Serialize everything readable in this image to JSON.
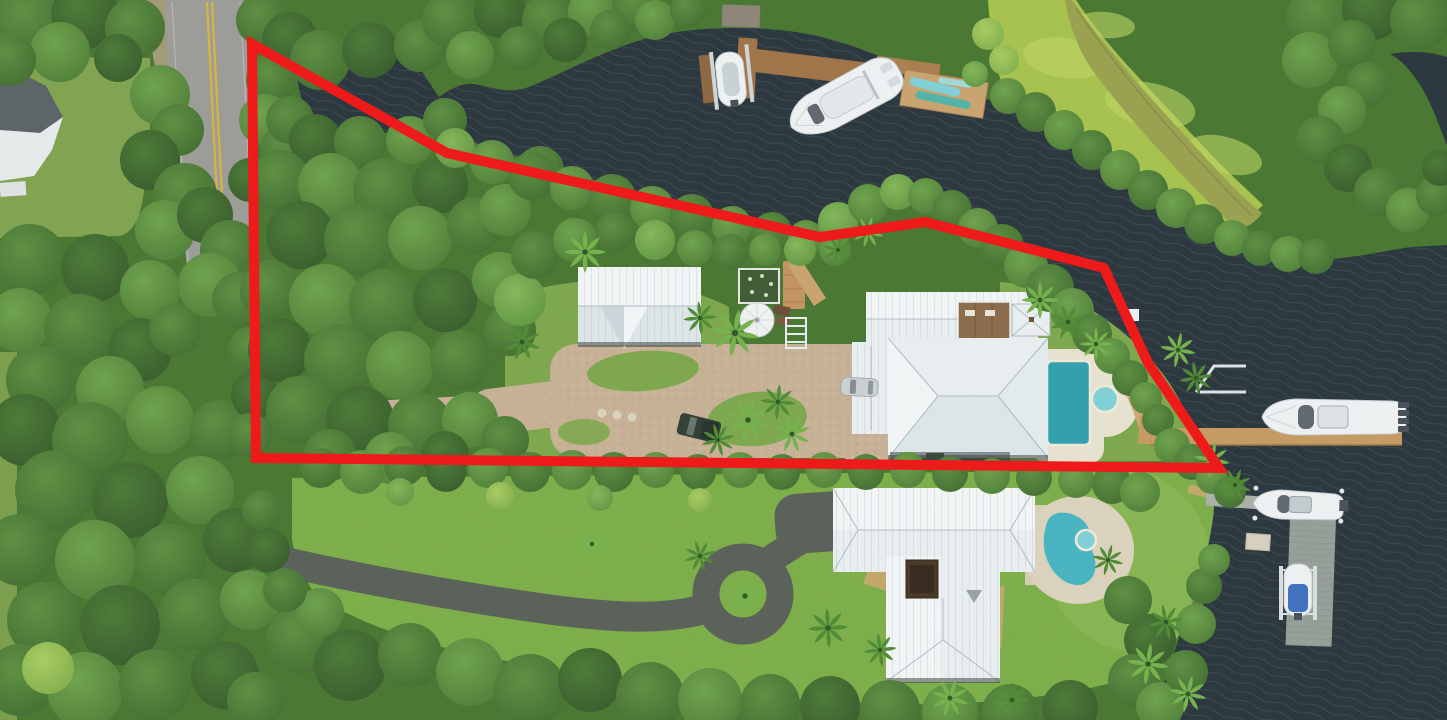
{
  "meta": {
    "type": "aerial-drone-photograph",
    "subject": "Top-down aerial photo of a wooded waterfront estate outlined with a red property boundary, beside a dark tidal canal and river with docks and boats",
    "visible_text": "none"
  },
  "colors": {
    "canopy": "#47762f",
    "treeDark": "#38622a",
    "treeMid": "#4c8034",
    "treeLight": "#5f9740",
    "treeBright": "#79ae4f",
    "treeLime": "#9cc35a",
    "water": "#28343b",
    "waterWave": "#93a7b1",
    "marsh": "#a7c24c",
    "marshLight": "#bdd561",
    "channel": "#99a14e",
    "road": "#9b9b97",
    "roadLine": "#d9b43e",
    "lawn": "#7ca74b",
    "lawnLower": "#7bae47",
    "lawnMuted": "#7fa34f",
    "lawnSlope": "#8fbb57",
    "gravel": "#c7b195",
    "asphalt": "#585f57",
    "sand": "#cfa671",
    "roofBright": "#f3f6f7",
    "roofLight": "#eaeff1",
    "roofMid": "#dde6e9",
    "roofShade": "#ccd7db",
    "roofLine": "#9fb0b6",
    "wood": "#8a6b4a",
    "deckTan": "#c9a36e",
    "patio": "#dcd3bd",
    "patioLight": "#e8e2d0",
    "poolUpper": "#2f9fae",
    "poolLower": "#46b4c1",
    "spa": "#7fd0d8",
    "dockBrown": "#a07246",
    "dockTan": "#c59a60",
    "dockGray": "#a9b0a8",
    "dockGrayDark": "#959e97",
    "boatWhite": "#eff2f3",
    "boatGray": "#c3cdd1",
    "boatDark": "#454f56",
    "coverBlue": "#3f6fbe",
    "kayakBlue": "#7fd0d8",
    "kayakTeal": "#4fb3a6",
    "truck": "#2f3d35",
    "carSilver": "#ccd1d2",
    "boundary": "#f01515",
    "palmDark": "#4e8a33",
    "palmLight": "#74b24a"
  },
  "boundary": {
    "label": "red property boundary outline",
    "points": "252,44 447,153 820,237 925,222 1104,268 1148,363 1219,468 256,458",
    "strokeWidth": 10
  },
  "features": {
    "road": "two-lane road with double yellow centerline under trees, upper left",
    "neighbor_house": "gray/white hip roof of neighboring house at far left edge",
    "canal": "dark winding tidal canal from upper left joining wide river on right",
    "marsh": "bright green marsh meadow with muddy channel, upper right",
    "upper_property": {
      "main_house": "large white hip-roof house with interior wood courtyard and gazebo",
      "guest_house": "white gable-roof outbuilding/garage",
      "pool": "rectangular turquoise pool with round spa and light patio",
      "driveway": "sandy gravel drive with grass palm islands and stepping stones",
      "details": [
        "white umbrella",
        "garden box",
        "wood bridge walkway",
        "white steps",
        "white entry gate"
      ]
    },
    "lower_property": {
      "house": "white cross-gable metal roof house with dark center courtyard",
      "pool": "kidney-shaped turquoise pool with spa on tan patio",
      "driveway": "dark asphalt drive with circular palm loop and parking apron"
    },
    "docks_and_boats": [
      "timber dock upper-center with small runabout on lift",
      "white flybridge yacht moored at upper dock",
      "floating platform with blue and teal kayaks",
      "long tan private dock on right with boat-lift frame",
      "large white yacht with four outboard engines",
      "white center-console boat on lift",
      "weathered gray L-shaped dock with storage box",
      "small skiff with blue cover on boat lift, lower right"
    ],
    "vehicles": [
      "dark pickup truck on gravel drive",
      "silver car parked by main house",
      "white car on road"
    ]
  }
}
